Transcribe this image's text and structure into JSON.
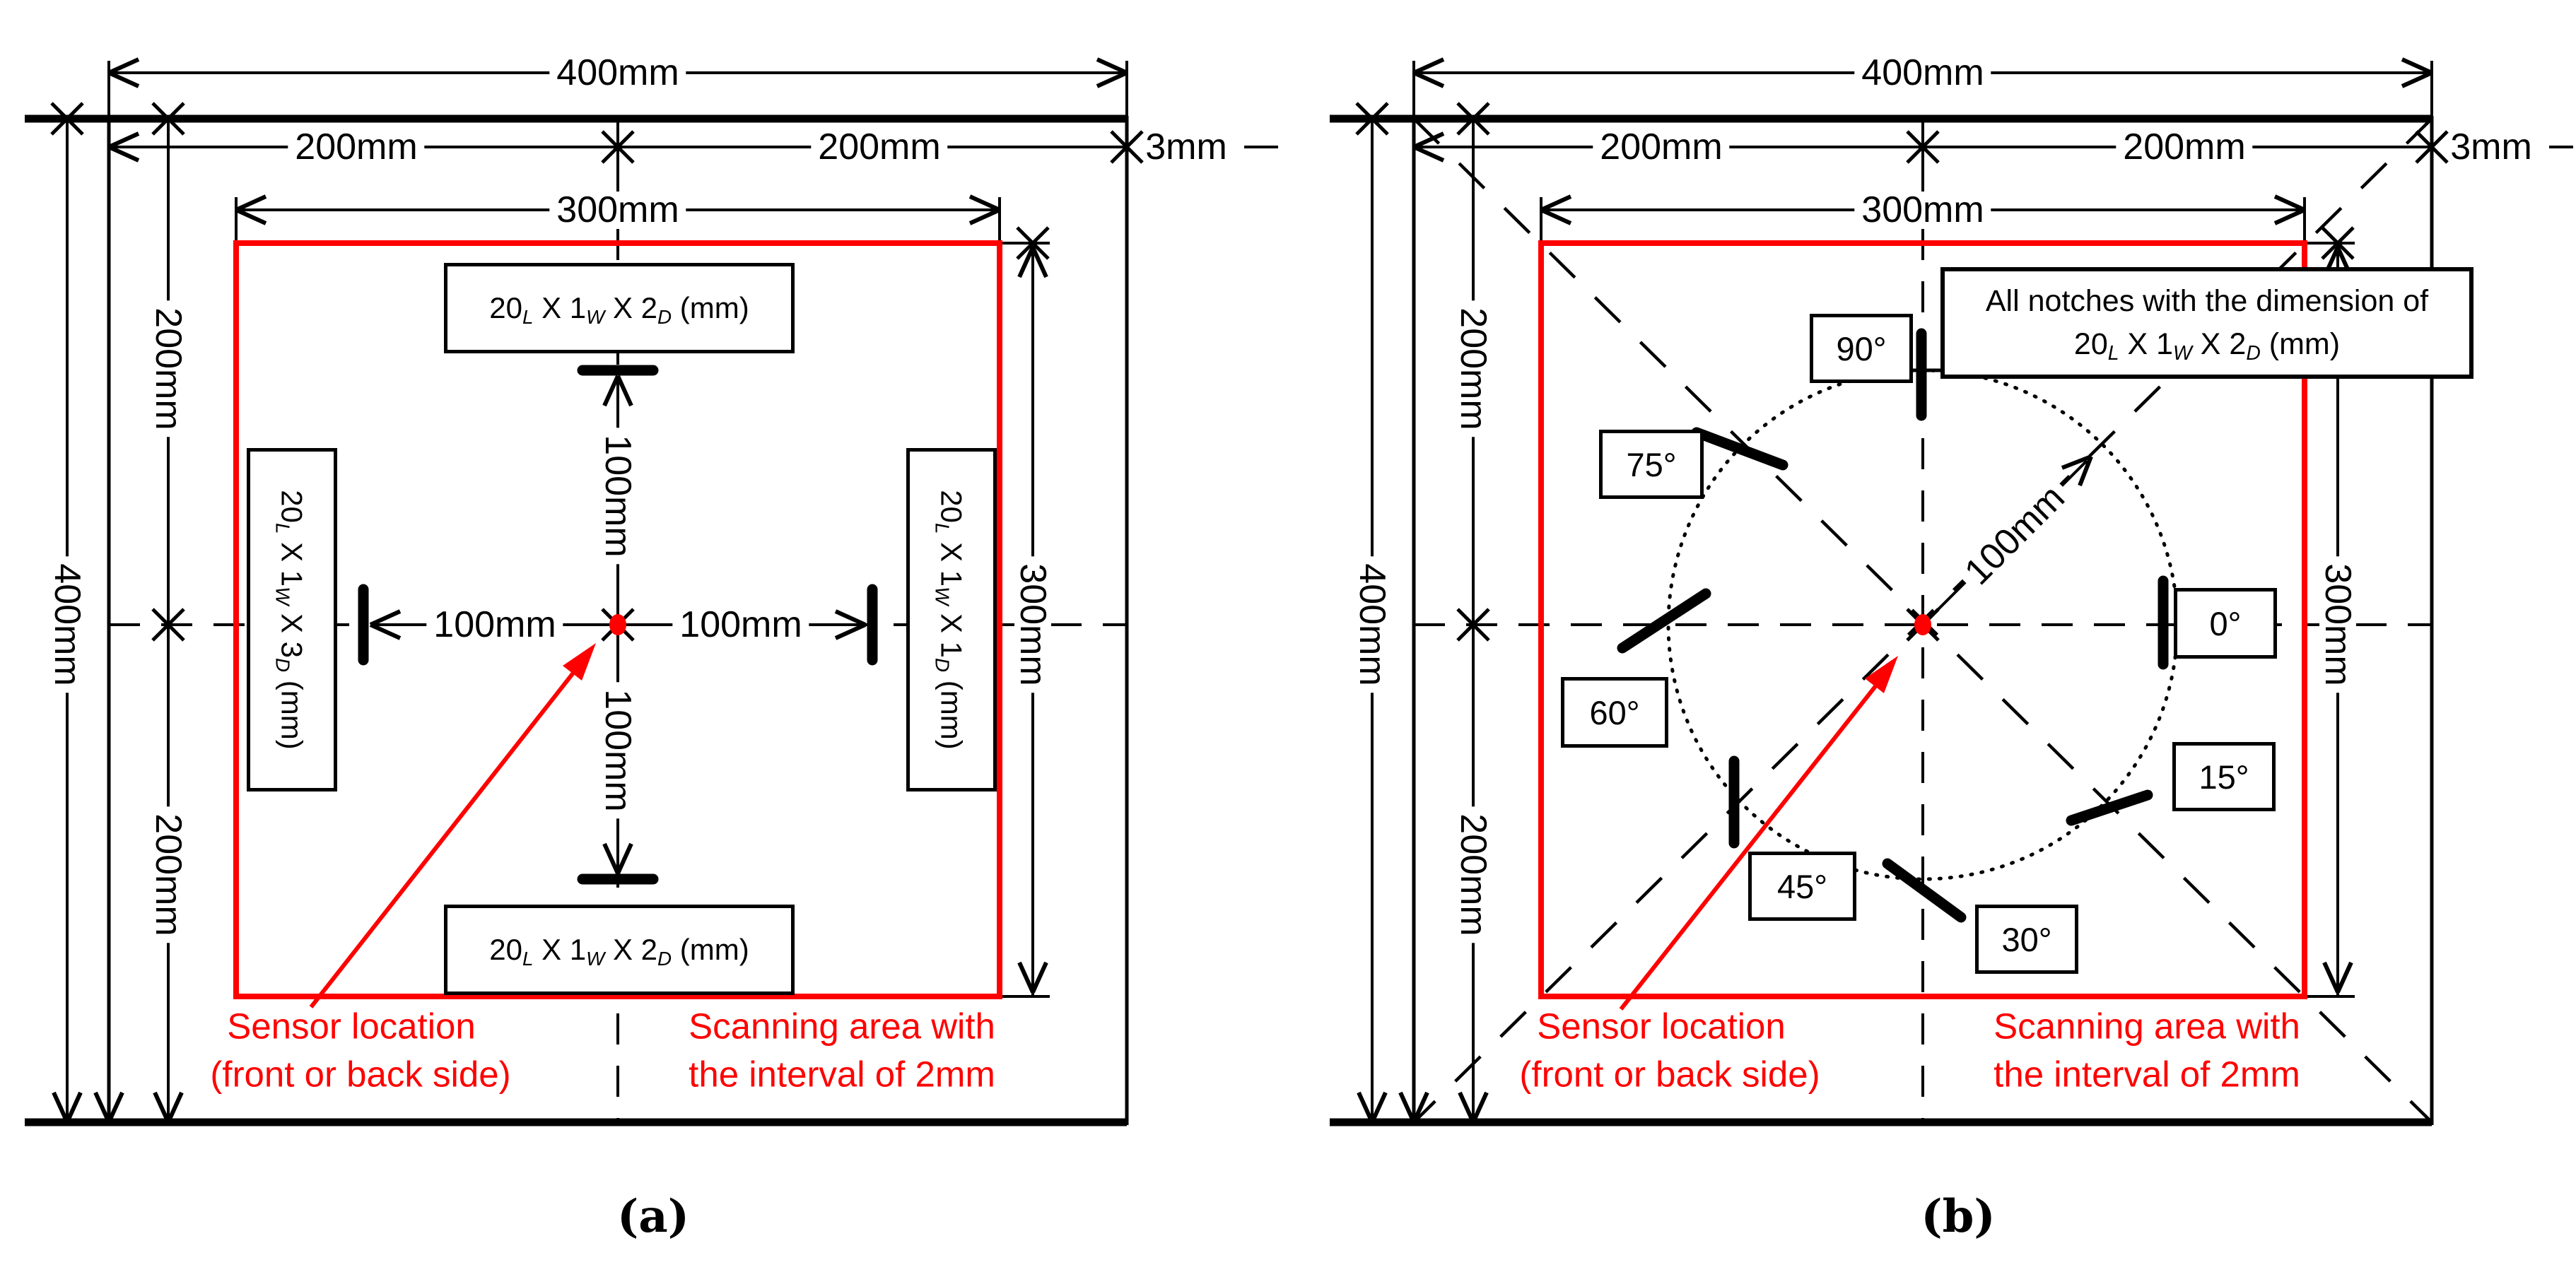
{
  "colors": {
    "background": "#ffffff",
    "line": "#000000",
    "accent_red": "#ff0000"
  },
  "panel_a": {
    "caption": "(a)",
    "dims": {
      "total_width": "400mm",
      "left_half": "200mm",
      "right_half": "200mm",
      "plate_thickness": "3mm",
      "scan_width": "300mm",
      "total_height": "400mm",
      "upper_height": "200mm",
      "lower_height": "200mm",
      "scan_height": "300mm",
      "offset_up": "100mm",
      "offset_down": "100mm",
      "offset_left": "100mm",
      "offset_right": "100mm"
    },
    "notch_top": [
      {
        "t": "20"
      },
      {
        "t": "L",
        "sub": true
      },
      {
        "t": " X 1"
      },
      {
        "t": "W",
        "sub": true
      },
      {
        "t": " X 2"
      },
      {
        "t": "D",
        "sub": true
      },
      {
        "t": " (mm)"
      }
    ],
    "notch_bottom": [
      {
        "t": "20"
      },
      {
        "t": "L",
        "sub": true
      },
      {
        "t": " X 1"
      },
      {
        "t": "W",
        "sub": true
      },
      {
        "t": " X 2"
      },
      {
        "t": "D",
        "sub": true
      },
      {
        "t": " (mm)"
      }
    ],
    "notch_left": [
      {
        "t": "20"
      },
      {
        "t": "L",
        "sub": true
      },
      {
        "t": " X 1"
      },
      {
        "t": "W",
        "sub": true
      },
      {
        "t": " X 3"
      },
      {
        "t": "D",
        "sub": true
      },
      {
        "t": " (mm)"
      }
    ],
    "notch_right": [
      {
        "t": "20"
      },
      {
        "t": "L",
        "sub": true
      },
      {
        "t": " X 1"
      },
      {
        "t": "W",
        "sub": true
      },
      {
        "t": " X 1"
      },
      {
        "t": "D",
        "sub": true
      },
      {
        "t": " (mm)"
      }
    ],
    "sensor_label": [
      "Sensor location",
      "(front or back side)"
    ],
    "scan_label": [
      "Scanning area with",
      "the interval of 2mm"
    ]
  },
  "panel_b": {
    "caption": "(b)",
    "dims": {
      "total_width": "400mm",
      "left_half": "200mm",
      "right_half": "200mm",
      "plate_thickness": "3mm",
      "scan_width": "300mm",
      "total_height": "400mm",
      "upper_height": "200mm",
      "lower_height": "200mm",
      "scan_height": "300mm",
      "radius": "100mm"
    },
    "angles": [
      "90°",
      "75°",
      "60°",
      "45°",
      "30°",
      "15°",
      "0°"
    ],
    "note_line1": "All notches with the dimension of",
    "note_line2": [
      {
        "t": "20"
      },
      {
        "t": "L",
        "sub": true
      },
      {
        "t": " X 1"
      },
      {
        "t": "W",
        "sub": true
      },
      {
        "t": " X 2"
      },
      {
        "t": "D",
        "sub": true
      },
      {
        "t": " (mm)"
      }
    ],
    "sensor_label": [
      "Sensor location",
      "(front or back side)"
    ],
    "scan_label": [
      "Scanning area with",
      "the interval of 2mm"
    ]
  }
}
